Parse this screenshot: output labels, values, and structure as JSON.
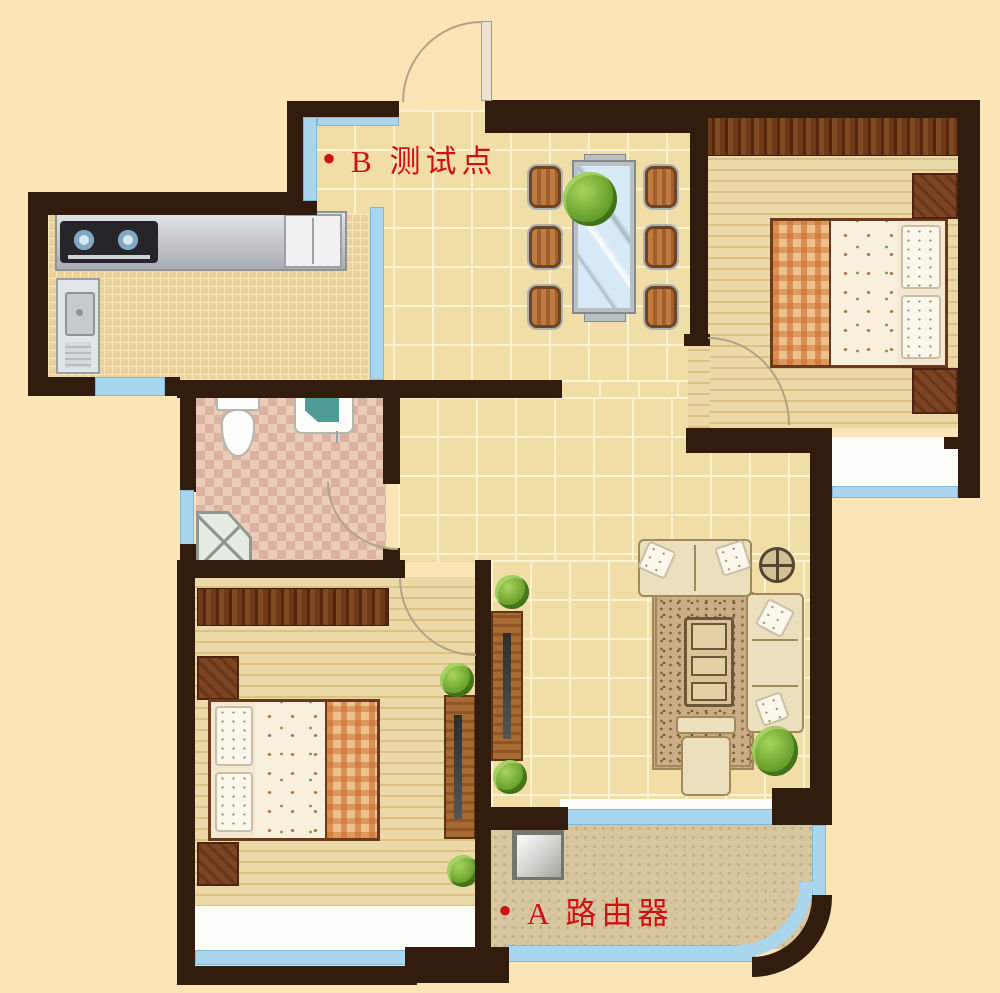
{
  "labels": {
    "test_point_b": {
      "bullet": "•",
      "text": "B 测试点"
    },
    "router_a": {
      "bullet": "•",
      "text": "A 路由器"
    }
  },
  "palette": {
    "background": "#fbe4b6",
    "wall": "#311c0d",
    "label_red": "#ce1212",
    "glass_blue": "#a9d6ec",
    "hall_tile": "#f1dda6",
    "kitchen_tile": "#ebd29b",
    "bathroom_tile": "#e9cdb9",
    "wood_floor": "#e9d6a4",
    "balcony_floor": "#d8c6a0",
    "wardrobe_wood": "#6e3918",
    "sofa_cream": "#ebdfbe"
  },
  "icons": {
    "router": "gray square box on balcony",
    "test_point_marker": "red bullet dot",
    "entry_door": "quarter-circle arc with leaf",
    "interior_door": "quarter-circle arc",
    "window": "light blue band",
    "stove": "dark block with two burners",
    "sink_cabinet": "gray unit with basin",
    "fridge": "white double-door unit",
    "dining_table": "glass table with six chairs",
    "bed": "plaid blanket, floral duvet, pillows",
    "wardrobe": "dark woodgrain strip",
    "nightstand": "small dark wood square",
    "toilet": "tank and bowl",
    "washbasin": "white box with teal basin",
    "shower": "corner pentagon with X",
    "sofa": "cream seat blocks",
    "coffee_table": "three-cell wooden table",
    "floor_lamp": "circle with cross",
    "plant": "green bush"
  }
}
